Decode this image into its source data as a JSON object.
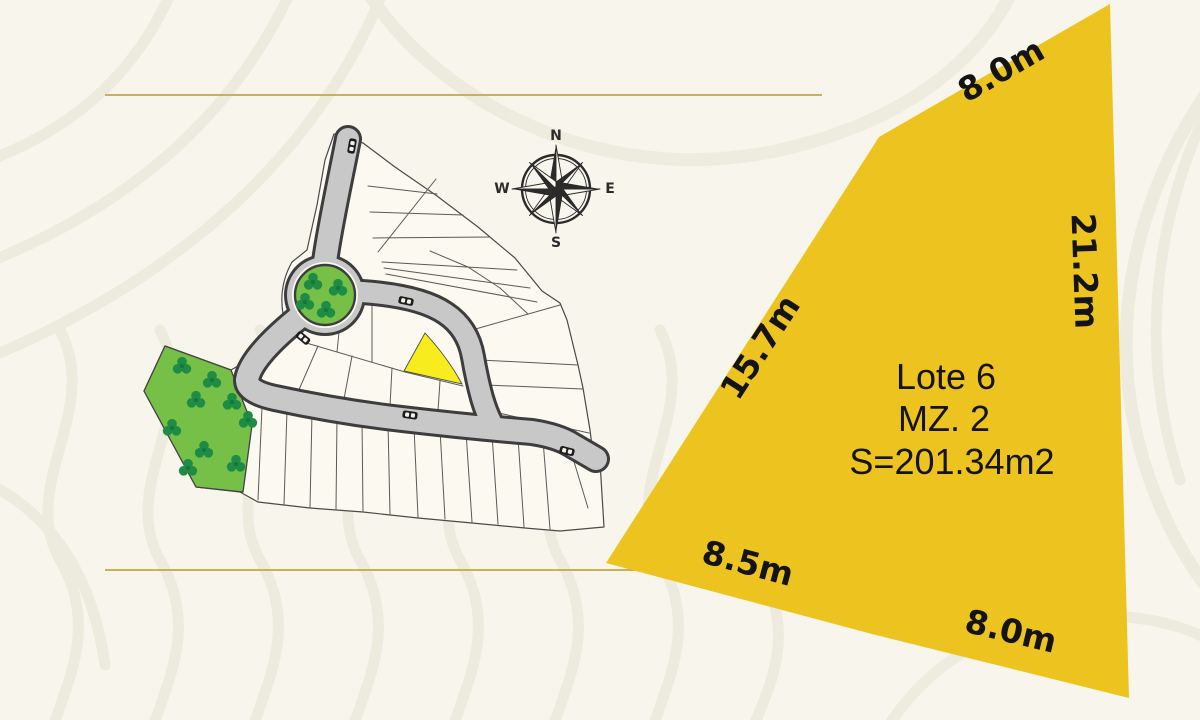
{
  "divider_lines": {
    "color": "#c7b259"
  },
  "site_plan": {
    "compass": {
      "north": "N",
      "east": "E",
      "south": "S",
      "west": "W"
    },
    "road_color": "#c8c8c8",
    "green_color": "#76c047",
    "highlight_color": "#f6ec1e"
  },
  "lot_card": {
    "name": "Lote 6",
    "block": "MZ. 2",
    "area": "S=201.34m2",
    "fill_color": "#edc41f",
    "dimensions": {
      "top": "8.0m",
      "right": "21.2m",
      "left": "15.7m",
      "bottom_left": "8.5m",
      "bottom_right": "8.0m"
    }
  }
}
